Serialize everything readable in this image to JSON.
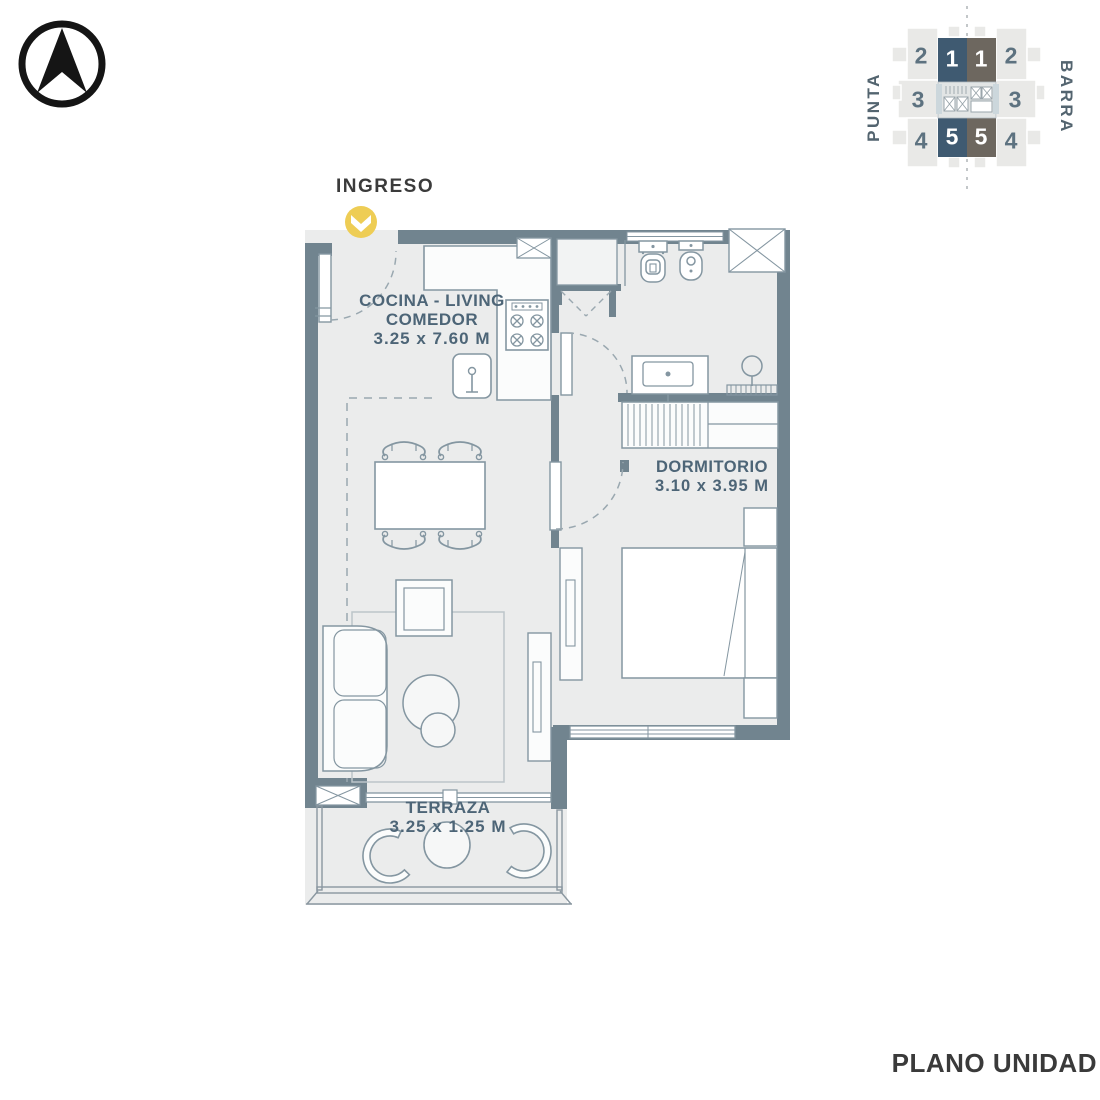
{
  "title": {
    "label": "PLANO UNIDAD"
  },
  "entry": {
    "label": "INGRESO"
  },
  "rooms": {
    "living": {
      "name": "COCINA - LIVING COMEDOR",
      "dims": "3.25 x 7.60 M"
    },
    "bedroom": {
      "name": "DORMITORIO",
      "dims": "3.10 x 3.95 M"
    },
    "terrace": {
      "name": "TERRAZA",
      "dims": "3.25 x 1.25 M"
    }
  },
  "keyplan": {
    "left_wing": "PUNTA",
    "right_wing": "BARRA",
    "units": [
      {
        "label": "2",
        "wing": "punta",
        "highlight": false
      },
      {
        "label": "1",
        "wing": "punta",
        "highlight": true
      },
      {
        "label": "1",
        "wing": "barra",
        "highlight": true
      },
      {
        "label": "2",
        "wing": "barra",
        "highlight": false
      },
      {
        "label": "3",
        "wing": "punta",
        "highlight": false
      },
      {
        "label": "3",
        "wing": "barra",
        "highlight": false
      },
      {
        "label": "4",
        "wing": "punta",
        "highlight": false
      },
      {
        "label": "5",
        "wing": "punta",
        "highlight": true
      },
      {
        "label": "5",
        "wing": "barra",
        "highlight": true
      },
      {
        "label": "4",
        "wing": "barra",
        "highlight": false
      }
    ]
  },
  "icons": {
    "compass": "north-arrow",
    "entry_marker": "chevron-down-badge"
  },
  "colors": {
    "wall": "#71848f",
    "floor": "#ebecec",
    "fixture_line": "#8496a1",
    "room_label": "#4d6577",
    "dark_text": "#3a3a3a",
    "accent_yellow": "#eecd55",
    "keyplan_punta_highlight": "#3f5a71",
    "keyplan_barra_highlight": "#6d675f",
    "keyplan_light_unit": "#e9e9e7"
  }
}
